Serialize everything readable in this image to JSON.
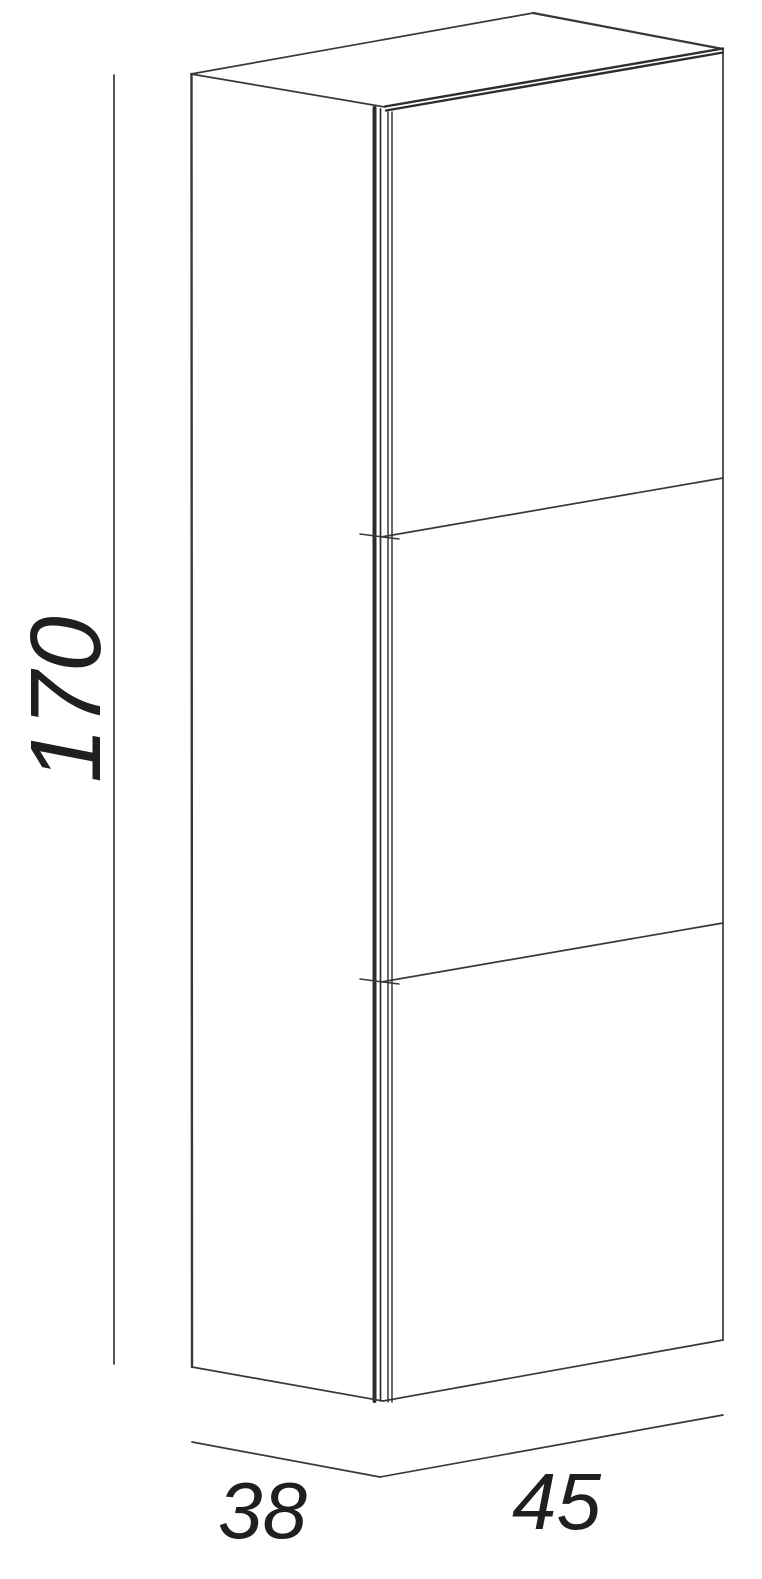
{
  "drawing": {
    "dimensions": {
      "height": {
        "label": "170"
      },
      "depth": {
        "label": "38"
      },
      "width": {
        "label": "45"
      }
    }
  },
  "colors": {
    "line": "#383838",
    "line_heavy": "#2d2d2d",
    "text": "#1f1f1f",
    "background": "#ffffff"
  }
}
